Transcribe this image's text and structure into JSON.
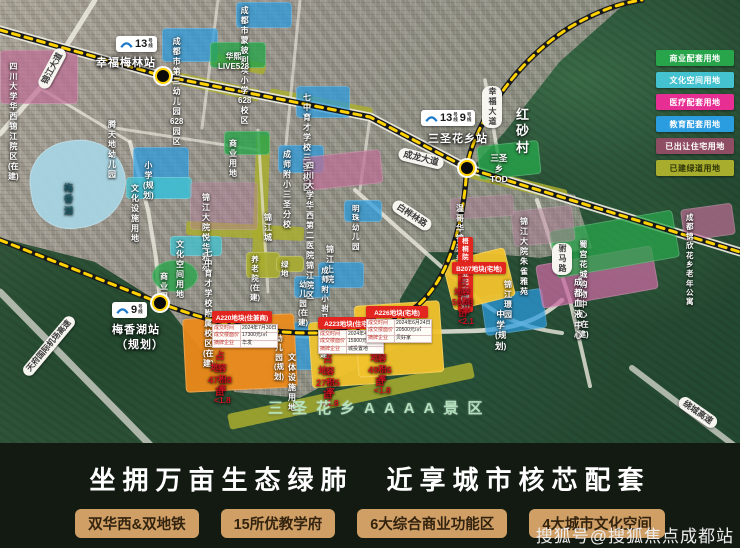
{
  "banner": {
    "slogan": "坐拥万亩生态绿肺　近享城市核芯配套",
    "badges": [
      "双华西&双地铁",
      "15所优教学府",
      "6大综合商业功能区",
      "4大城市文化空间"
    ],
    "watermark": "搜狐号@搜狐焦点成都站"
  },
  "legend": {
    "items": [
      {
        "label": "商业配套用地",
        "color": "#28a54b",
        "text_color": "#ffffff"
      },
      {
        "label": "文化空间用地",
        "color": "#45c2cf",
        "text_color": "#ffffff"
      },
      {
        "label": "医疗配套用地",
        "color": "#e72f93",
        "text_color": "#ffffff"
      },
      {
        "label": "教育配套用地",
        "color": "#2a9ce0",
        "text_color": "#ffffff"
      },
      {
        "label": "已出让住宅用地",
        "color": "#8e4d62",
        "text_color": "#ffffff"
      },
      {
        "label": "已建绿道用地",
        "color": "#a9ad2e",
        "text_color": "#2e3507"
      }
    ]
  },
  "metro": {
    "stripe_color": "#ffd200",
    "base_color": "#17181a",
    "line13_path": "M0,30 L163,76 L370,117 L467,168 L740,252",
    "line9_path": "M0,240 L160,303 C230,330 300,340 370,328 C432,317 452,262 461,215 C466,190 466,175 467,168 C472,128 515,60 572,26 C598,11 620,3 642,0"
  },
  "stations": [
    {
      "name": "station-xingfumeilin",
      "lines": [
        "13号线"
      ],
      "label": "幸福梅林站",
      "note": "",
      "logo": {
        "x": 116,
        "y": 36
      },
      "label_pos": {
        "x": 96,
        "y": 54
      },
      "dot": {
        "x": 163,
        "y": 76
      }
    },
    {
      "name": "station-sanshenghuaxiang",
      "lines": [
        "13号线",
        "9号线"
      ],
      "label": "三圣花乡站",
      "note": "",
      "logo": {
        "x": 421,
        "y": 110
      },
      "label_pos": {
        "x": 428,
        "y": 130
      },
      "dot": {
        "x": 467,
        "y": 168
      }
    },
    {
      "name": "station-meixianghu",
      "lines": [
        "9号线"
      ],
      "label": "梅香湖站",
      "note": "（规划）",
      "logo": {
        "x": 112,
        "y": 302
      },
      "label_pos": {
        "x": 112,
        "y": 321
      },
      "dot": {
        "x": 160,
        "y": 303
      }
    }
  ],
  "roads": [
    {
      "d": "M0,30 L163,76 L370,117 L467,168 L740,252",
      "w": 9,
      "o": 0.92
    },
    {
      "d": "M95,0 L40,88 L0,134",
      "w": 5,
      "o": 0.85
    },
    {
      "d": "M40,88 L130,142",
      "w": 3,
      "o": 0.7
    },
    {
      "d": "M130,142 L148,210 L156,258 L160,303",
      "w": 4,
      "o": 0.8
    },
    {
      "d": "M160,303 C235,332 310,344 380,333 L470,331 C515,330 540,320 562,300",
      "w": 4.5,
      "o": 0.85
    },
    {
      "d": "M355,190 L470,292 C498,318 525,328 562,333",
      "w": 4,
      "o": 0.8
    },
    {
      "d": "M537,200 L570,300 L590,386",
      "w": 4,
      "o": 0.8
    },
    {
      "d": "M485,80 L500,166",
      "w": 3.5,
      "o": 0.75
    },
    {
      "d": "M258,130 L268,292",
      "w": 3,
      "o": 0.65
    },
    {
      "d": "M115,128 L258,150",
      "w": 3,
      "o": 0.65
    },
    {
      "d": "M218,0 L202,128",
      "w": 3,
      "o": 0.6
    },
    {
      "d": "M300,0 L286,145",
      "w": 3,
      "o": 0.6
    },
    {
      "d": "M370,117 L360,190",
      "w": 3,
      "o": 0.6
    },
    {
      "d": "M467,168 L455,240",
      "w": 3,
      "o": 0.6
    },
    {
      "d": "M0,292 L150,445",
      "w": 7,
      "o": 0.8,
      "c": "#cfd2c8"
    },
    {
      "d": "M632,368 L740,450",
      "w": 6,
      "o": 0.8,
      "c": "#cfd2c8"
    }
  ],
  "strips": [
    {
      "x": 166,
      "y": 80,
      "w": 95,
      "h": 12,
      "rot": 12
    },
    {
      "x": 268,
      "y": 98,
      "w": 105,
      "h": 12,
      "rot": 11
    },
    {
      "x": 254,
      "y": 135,
      "w": 14,
      "h": 135,
      "rot": 2
    },
    {
      "x": 186,
      "y": 224,
      "w": 118,
      "h": 14,
      "rot": 3
    },
    {
      "x": 208,
      "y": 58,
      "w": 58,
      "h": 11,
      "rot": 12
    },
    {
      "x": 226,
      "y": 388,
      "w": 250,
      "h": 16,
      "rot": -12
    },
    {
      "x": 468,
      "y": 178,
      "w": 100,
      "h": 12,
      "rot": 14
    }
  ],
  "strip_color": "#a9ad2e",
  "parcels": [
    {
      "n": "lake-meixianghu",
      "x": 30,
      "y": 140,
      "w": 96,
      "h": 88,
      "c": "#a7d4e2",
      "o": 0.95,
      "rot": -8,
      "br": "48% 52% 55% 45%"
    },
    {
      "n": "parcel-education",
      "x": 162,
      "y": 28,
      "w": 56,
      "h": 34,
      "c": "#2a9ce0",
      "o": 0.72
    },
    {
      "n": "parcel-education",
      "x": 236,
      "y": 2,
      "w": 56,
      "h": 26,
      "c": "#2a9ce0",
      "o": 0.72
    },
    {
      "n": "parcel-education",
      "x": 296,
      "y": 86,
      "w": 54,
      "h": 32,
      "c": "#2a9ce0",
      "o": 0.72
    },
    {
      "n": "parcel-education",
      "x": 133,
      "y": 147,
      "w": 56,
      "h": 52,
      "c": "#2a9ce0",
      "o": 0.72
    },
    {
      "n": "parcel-culture",
      "x": 126,
      "y": 177,
      "w": 66,
      "h": 22,
      "c": "#45c2cf",
      "o": 0.8
    },
    {
      "n": "parcel-education",
      "x": 278,
      "y": 145,
      "w": 46,
      "h": 28,
      "c": "#2a9ce0",
      "o": 0.72
    },
    {
      "n": "parcel-education",
      "x": 344,
      "y": 200,
      "w": 38,
      "h": 22,
      "c": "#2a9ce0",
      "o": 0.72
    },
    {
      "n": "parcel-education",
      "x": 318,
      "y": 262,
      "w": 46,
      "h": 26,
      "c": "#2a9ce0",
      "o": 0.72
    },
    {
      "n": "parcel-education",
      "x": 294,
      "y": 276,
      "w": 36,
      "h": 22,
      "c": "#2a9ce0",
      "o": 0.72
    },
    {
      "n": "parcel-education",
      "x": 483,
      "y": 292,
      "w": 62,
      "h": 40,
      "c": "#2a9ce0",
      "o": 0.72,
      "rot": -8
    },
    {
      "n": "parcel-education",
      "x": 272,
      "y": 322,
      "w": 58,
      "h": 48,
      "c": "#2a9ce0",
      "o": 0.72
    },
    {
      "n": "parcel-medical",
      "x": 0,
      "y": 50,
      "w": 78,
      "h": 54,
      "c": "#c06d96",
      "o": 0.7
    },
    {
      "n": "parcel-medical",
      "x": 304,
      "y": 153,
      "w": 78,
      "h": 34,
      "c": "#c06d96",
      "o": 0.7,
      "rot": -6
    },
    {
      "n": "parcel-medical",
      "x": 538,
      "y": 255,
      "w": 118,
      "h": 44,
      "c": "#c868a0",
      "o": 0.75,
      "rot": -10
    },
    {
      "n": "parcel-medical",
      "x": 682,
      "y": 206,
      "w": 52,
      "h": 32,
      "c": "#c06d96",
      "o": 0.7,
      "rot": -8
    },
    {
      "n": "parcel-commercial",
      "x": 210,
      "y": 42,
      "w": 56,
      "h": 26,
      "c": "#28a54b",
      "o": 0.8
    },
    {
      "n": "parcel-commercial",
      "x": 224,
      "y": 131,
      "w": 46,
      "h": 24,
      "c": "#28a54b",
      "o": 0.8
    },
    {
      "n": "parcel-commercial",
      "x": 152,
      "y": 260,
      "w": 46,
      "h": 32,
      "c": "#28a54b",
      "o": 0.8,
      "br": "50%"
    },
    {
      "n": "parcel-commercial",
      "x": 478,
      "y": 143,
      "w": 62,
      "h": 34,
      "c": "#28a54b",
      "o": 0.8,
      "rot": -6
    },
    {
      "n": "parcel-commercial",
      "x": 552,
      "y": 220,
      "w": 125,
      "h": 48,
      "c": "#28a54b",
      "o": 0.75,
      "rot": -10
    },
    {
      "n": "parcel-culture",
      "x": 170,
      "y": 236,
      "w": 52,
      "h": 20,
      "c": "#45c2cf",
      "o": 0.8
    },
    {
      "n": "parcel-residential-sold",
      "x": 190,
      "y": 182,
      "w": 68,
      "h": 48,
      "c": "#b57f9b",
      "o": 0.45
    },
    {
      "n": "parcel-residential-sold",
      "x": 512,
      "y": 208,
      "w": 62,
      "h": 36,
      "c": "#b57f9b",
      "o": 0.5,
      "rot": -6
    },
    {
      "n": "parcel-residential-sold",
      "x": 450,
      "y": 196,
      "w": 64,
      "h": 22,
      "c": "#b57f9b",
      "o": 0.45,
      "rot": -4
    },
    {
      "n": "parcel-greenway",
      "x": 246,
      "y": 252,
      "w": 34,
      "h": 26,
      "c": "#a9ad2e",
      "o": 0.9
    },
    {
      "n": "parcel-greenway",
      "x": 276,
      "y": 256,
      "w": 28,
      "h": 16,
      "c": "#a9ad2e",
      "o": 0.9
    },
    {
      "n": "parcel-b207",
      "x": 447,
      "y": 254,
      "w": 64,
      "h": 50,
      "c": "#f3c32c",
      "o": 0.95,
      "rot": -14
    },
    {
      "n": "parcel-a220",
      "x": 184,
      "y": 316,
      "w": 112,
      "h": 74,
      "c": "#ec8a1a",
      "o": 0.95,
      "rot": -3
    },
    {
      "n": "parcel-a223",
      "x": 310,
      "y": 320,
      "w": 72,
      "h": 66,
      "c": "#f3c32c",
      "o": 0.95,
      "rot": -4
    },
    {
      "n": "parcel-a226",
      "x": 356,
      "y": 303,
      "w": 86,
      "h": 72,
      "c": "#f3c32c",
      "o": 0.95,
      "rot": -4
    }
  ],
  "labels": [
    {
      "name": "huaxi-jinjiang-hospital",
      "t": "四川大学华西\n锦江院区(在建)",
      "x": 8,
      "y": 62,
      "fs": 8
    },
    {
      "name": "no3-kindergarten-628",
      "t": "成都市第三幼儿园\n628园区",
      "x": 170,
      "y": 37,
      "fs": 8
    },
    {
      "name": "mengbiliai-primary-628",
      "t": "成都市蒙彼利埃小学\n628校区",
      "x": 238,
      "y": 6,
      "fs": 8
    },
    {
      "name": "huaxi-live528",
      "t": "华熙LIVE528",
      "x": 218,
      "y": 52,
      "fs": 8
    },
    {
      "name": "qizhong-yucai-sansheng",
      "t": "七中育才学校\n三圣校区",
      "x": 303,
      "y": 93,
      "fs": 8
    },
    {
      "name": "tengtiandi-kindergarten",
      "t": "腾天地幼儿园",
      "x": 108,
      "y": 120,
      "fs": 8
    },
    {
      "name": "primary-school-planned",
      "t": "小学(规划)",
      "x": 143,
      "y": 161,
      "fs": 8
    },
    {
      "name": "cultural-facility-land",
      "t": "文化设施用地",
      "x": 131,
      "y": 184,
      "fs": 8
    },
    {
      "name": "business-land-north",
      "t": "商业用地",
      "x": 229,
      "y": 139,
      "fs": 8
    },
    {
      "name": "chengshifuxiao-sansheng",
      "t": "成师附小\n三圣分校",
      "x": 283,
      "y": 150,
      "fs": 8
    },
    {
      "name": "huaxi-second-hospital",
      "t": "四川大学华西第二医院\n锦江院区",
      "x": 306,
      "y": 161,
      "fs": 8
    },
    {
      "name": "meixiang-lake-label",
      "t": "梅香湖",
      "x": 64,
      "y": 183,
      "fs": 9,
      "c": "#1d5a66"
    },
    {
      "name": "jinjiang-dayuan-yuehua",
      "t": "锦江大院\n悦华雅苑",
      "x": 202,
      "y": 193,
      "fs": 8
    },
    {
      "name": "jinjiang-city",
      "t": "锦江城",
      "x": 264,
      "y": 213,
      "fs": 8
    },
    {
      "name": "mingzhu-kindergarten",
      "t": "明珠\n幼儿园",
      "x": 352,
      "y": 204,
      "fs": 7.5
    },
    {
      "name": "wengehua-jinjiang-chuntian",
      "t": "温哥华锦江春天",
      "x": 456,
      "y": 204,
      "fs": 8
    },
    {
      "name": "jinjiang-dayuan-zhuque",
      "t": "锦江大院\n朱雀雅苑",
      "x": 520,
      "y": 217,
      "fs": 8
    },
    {
      "name": "culture-space-land",
      "t": "文化空间用地",
      "x": 176,
      "y": 240,
      "fs": 8
    },
    {
      "name": "qizhong-yucai-fushu",
      "t": "七中育才学校\n附属校区(在建)",
      "x": 203,
      "y": 249,
      "fs": 8
    },
    {
      "name": "jinjiang-shangyuan",
      "t": "锦江上院",
      "x": 326,
      "y": 245,
      "fs": 8
    },
    {
      "name": "nursing-home-inbuild",
      "t": "养老院\n(在建)",
      "x": 250,
      "y": 255,
      "fs": 7.5
    },
    {
      "name": "green-space",
      "t": "绿地",
      "x": 281,
      "y": 260,
      "fs": 7.5
    },
    {
      "name": "business-land-circle",
      "t": "商业用地",
      "x": 160,
      "y": 272,
      "fs": 8
    },
    {
      "name": "chengshifuxiao-fuma",
      "t": "成师附小\n驸马校区(在建)",
      "x": 320,
      "y": 266,
      "fs": 7.5
    },
    {
      "name": "kindergarten-inbuild",
      "t": "幼儿园\n(在建)",
      "x": 298,
      "y": 280,
      "fs": 7.5
    },
    {
      "name": "hongsha-village",
      "t": "红 砂 村",
      "x": 516,
      "y": 107,
      "fs": 13,
      "ls": 4
    },
    {
      "name": "sanshengxiang-tod",
      "t": "三圣乡TOD",
      "x": 490,
      "y": 153,
      "fs": 8.5
    },
    {
      "name": "shugong-huacheng-mall",
      "t": "蜀宫花城购物中心(在建)",
      "x": 578,
      "y": 240,
      "fs": 8
    },
    {
      "name": "chengdu-blood-center",
      "t": "成都血液中心",
      "x": 574,
      "y": 277,
      "fs": 8.5
    },
    {
      "name": "jinxin-elderly-apartment",
      "t": "成都锦欣花乡\n老年公寓",
      "x": 686,
      "y": 213,
      "fs": 7.5
    },
    {
      "name": "jinjiang-jingyuan",
      "t": "锦江璟园",
      "x": 504,
      "y": 280,
      "fs": 8
    },
    {
      "name": "middle-school-planned",
      "t": "中学(规划)",
      "x": 495,
      "y": 309,
      "fs": 8.5
    },
    {
      "name": "kindergarten-planned",
      "t": "幼儿园(规划)",
      "x": 274,
      "y": 334,
      "fs": 7.5
    },
    {
      "name": "cultural-sports-land",
      "t": "文体设施用地",
      "x": 288,
      "y": 353,
      "fs": 8
    },
    {
      "name": "road-jinjiang-avenue",
      "t": "锦江大道",
      "x": 30,
      "y": 62,
      "fs": 8.5,
      "pill": "white",
      "rot": -62
    },
    {
      "name": "road-chenglong-avenue",
      "t": "成龙大道",
      "x": 398,
      "y": 152,
      "fs": 9,
      "pill": "white",
      "rot": 14
    },
    {
      "name": "road-baihualin",
      "t": "白桦林路",
      "x": 390,
      "y": 209,
      "fs": 8.5,
      "pill": "white",
      "rot": 33
    },
    {
      "name": "road-xingfu-avenue",
      "t": "幸福大道",
      "x": 482,
      "y": 86,
      "fs": 8,
      "pill": "white",
      "vert": 1
    },
    {
      "name": "road-fuma",
      "t": "驸马路",
      "x": 552,
      "y": 243,
      "fs": 8,
      "pill": "white",
      "vert": 1
    },
    {
      "name": "road-tianfu-airport-expressway",
      "t": "天府国际机场高速",
      "x": 12,
      "y": 340,
      "fs": 8,
      "pill": "white",
      "rot": -50
    },
    {
      "name": "road-raocheng-expressway",
      "t": "绕城高速",
      "x": 676,
      "y": 406,
      "fs": 8.5,
      "pill": "white",
      "rot": 35
    },
    {
      "name": "wutongyuan-commercial-pill",
      "t": "梧桐院\n商业配套(规划)",
      "x": 458,
      "y": 237,
      "fs": 6.5,
      "pill": "red"
    },
    {
      "name": "b207-area-text",
      "t": "占地：  56.68亩",
      "x": 452,
      "y": 276,
      "fs": 8.5,
      "c": "#cf1322"
    },
    {
      "name": "b207-far-text",
      "t": "容积率<2.1",
      "x": 458,
      "y": 287,
      "fs": 8,
      "c": "#cf1322"
    },
    {
      "name": "a220-area-text",
      "t": "占地：  47.68亩",
      "x": 208,
      "y": 351,
      "fs": 9.5,
      "c": "#cf1322"
    },
    {
      "name": "a220-far-text",
      "t": "容积率<1.8",
      "x": 214,
      "y": 363,
      "fs": 8.5,
      "c": "#cf1322"
    },
    {
      "name": "a223-area-text",
      "t": "占地：  27.95亩",
      "x": 316,
      "y": 354,
      "fs": 9.5,
      "c": "#cf1322"
    },
    {
      "name": "a223-far-text",
      "t": "容积率<1.8",
      "x": 322,
      "y": 366,
      "fs": 8.5,
      "c": "#cf1322"
    },
    {
      "name": "a226-area-text",
      "t": "占地：  49.96亩",
      "x": 368,
      "y": 341,
      "fs": 9.5,
      "c": "#cf1322"
    },
    {
      "name": "a226-far-text",
      "t": "容积率<1.8",
      "x": 374,
      "y": 353,
      "fs": 8.5,
      "c": "#cf1322"
    }
  ],
  "scenic": {
    "text": "三圣花乡AAAA景区",
    "x": 268,
    "y": 397,
    "fs": 15,
    "ls": 9
  },
  "land_cards": [
    {
      "name": "card-a220",
      "x": 212,
      "y": 311,
      "w": 60,
      "header": "A220地块(住兼商)",
      "rows": [
        [
          "成交时间",
          "2024年7月30日"
        ],
        [
          "成交楼面价",
          "17300元/㎡"
        ],
        [
          "摘牌企业",
          "华发"
        ]
      ]
    },
    {
      "name": "card-a223",
      "x": 318,
      "y": 317,
      "w": 58,
      "header": "A223地块(住宅)",
      "rows": [
        [
          "成交时间",
          "2024年4月27日"
        ],
        [
          "成交楼面价",
          "15900元/㎡"
        ],
        [
          "摘牌企业",
          "城投置地"
        ]
      ]
    },
    {
      "name": "card-a226",
      "x": 366,
      "y": 306,
      "w": 62,
      "header": "A226地块(宅地)",
      "rows": [
        [
          "成交时间",
          "2024年6月24日"
        ],
        [
          "成交楼面价",
          "20500元/㎡"
        ],
        [
          "摘牌企业",
          "贝好家"
        ]
      ]
    },
    {
      "name": "card-b207",
      "x": 452,
      "y": 262,
      "w": 54,
      "header": "B207地块(宅地)",
      "rows": []
    }
  ]
}
